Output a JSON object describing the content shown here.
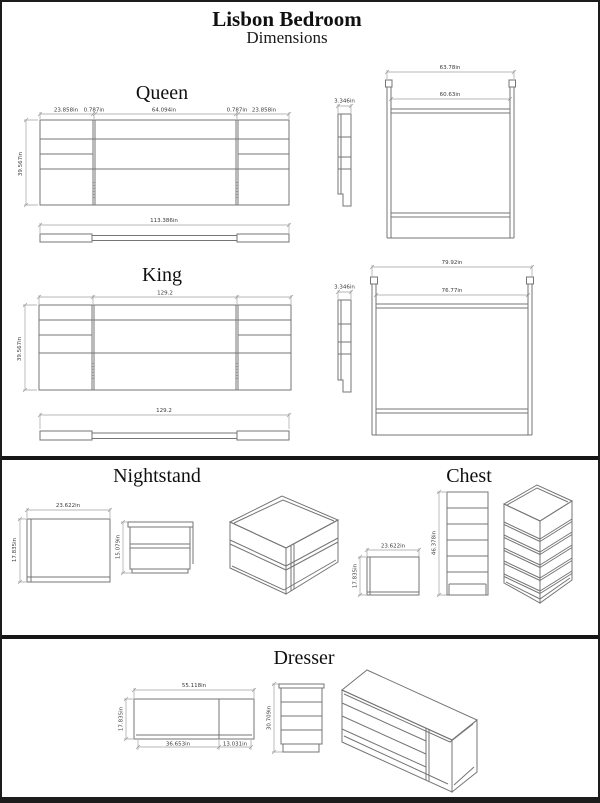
{
  "page": {
    "title": "Lisbon Bedroom",
    "subtitle": "Dimensions"
  },
  "queen": {
    "label": "Queen",
    "panel_left_width": "23.858in",
    "panel_gap_left": "0.787in",
    "center_width": "64.094in",
    "panel_gap_right": "0.787in",
    "panel_right_width": "23.858in",
    "height": "39.567in",
    "side_thickness": "3.346in",
    "frame_outer_width": "63.78in",
    "frame_inner_width": "60.63in",
    "rail_length": "113.386in"
  },
  "king": {
    "label": "King",
    "total_width": "129.2",
    "height": "39.567in",
    "side_thickness": "3.346in",
    "frame_outer_width": "79.92in",
    "frame_inner_width": "76.77in",
    "rail_length": "129.2"
  },
  "nightstand": {
    "label": "Nightstand",
    "width": "23.622in",
    "depth": "17.835in",
    "height": "15.079in"
  },
  "chest": {
    "label": "Chest",
    "width": "23.622in",
    "depth": "17.835in",
    "height": "46.378in"
  },
  "dresser": {
    "label": "Dresser",
    "width": "55.118in",
    "depth": "17.835in",
    "height": "30.709in",
    "base_left_width": "36.653in",
    "base_right_width": "13.031in"
  }
}
